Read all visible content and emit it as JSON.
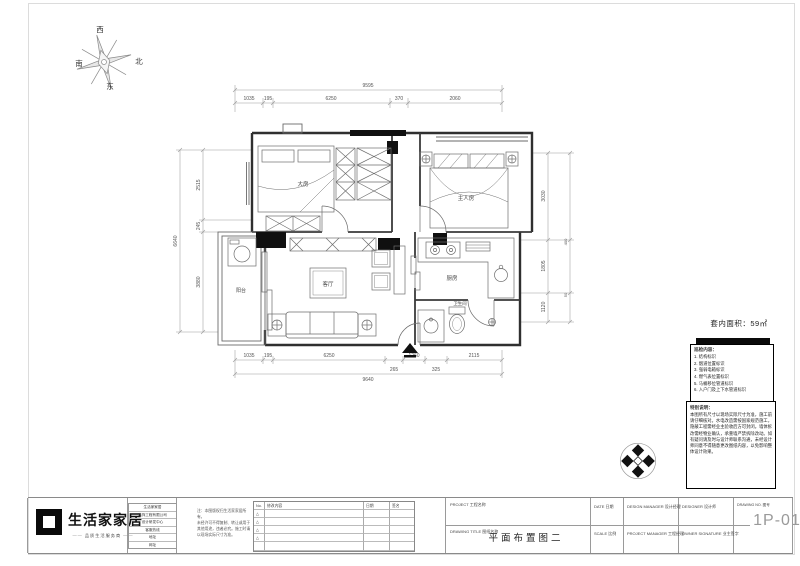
{
  "compass": {
    "west": "西",
    "north": "北",
    "south": "南",
    "east": "东"
  },
  "plan": {
    "rooms": {
      "bedroom": "大房",
      "master": "主人房",
      "kitchen": "厨房",
      "bath": "卫生间",
      "living": "客厅",
      "balcony": "阳台"
    },
    "dims": {
      "top": {
        "total": "9595",
        "segs": [
          "1035",
          "195",
          "6250",
          "370",
          "2060"
        ]
      },
      "bottom": {
        "segs": [
          "1035",
          "195",
          "6250",
          "1260",
          "2115"
        ],
        "sub": [
          "265",
          "325"
        ],
        "total": "9640"
      },
      "left": {
        "total": "6640",
        "segs": [
          "2515",
          "245",
          "3880"
        ]
      },
      "right": {
        "segs": [
          "3030",
          "1805",
          "1120"
        ],
        "sub": [
          "400",
          "50"
        ]
      }
    }
  },
  "info": {
    "area": "套内面积：59㎡",
    "legend_title": "巡检内容：",
    "legend_items": [
      "1. 结构标识",
      "2. 烟道位置标识",
      "3. 强弱电箱标识",
      "4. 燃气表位置标识",
      "5. 马桶移位管道标识",
      "6. 入户门及上下水管道标识"
    ],
    "notes_title": "特别说明：",
    "notes_body": "本图所有尺寸以现场实际尺寸为准，施工前请仔细核对。水电改造需按国家规范施工，隐蔽工程需经业主验收后方可封闭。墙体拆改需经物业确认，承重墙严禁拆除改动。如有疑问请及时与设计师联系沟通，未经设计师同意不得随意更改图纸内容，以免影响整体设计效果。"
  },
  "titlebar": {
    "brand": "生活家家居",
    "slogan": "品质生活服务商",
    "company_rows": [
      "生活家家居",
      "装饰工程有限公司",
      "设计研发中心",
      "客服热线",
      "地址",
      "网址"
    ],
    "note_lines": [
      "注：本图版权归生活家家居所有，",
      "未经许可不得复制、转让或用于",
      "其他用途，违者必究。施工时请",
      "以现场实际尺寸为准。"
    ],
    "rev": {
      "headers": [
        "No.",
        "修改内容",
        "日期",
        "签名"
      ],
      "marks": [
        "△",
        "△",
        "△",
        "△"
      ]
    },
    "project_label": "PROJECT  工程名称",
    "title_label": "DRAWING TITLE  图纸名称",
    "drawing_title": "平面布置图二",
    "date_label": "DATE  日期",
    "scale_label": "SCALE  比例",
    "design_mgr_label": "DESIGN MANAGER  设计经理",
    "project_mgr_label": "PROJECT MANAGER  工程经理",
    "designer_label": "DESIGNER  设计师",
    "owner_label": "OWNER SIGNATURE  业主签字",
    "drawing_no_label": "DRAWING NO.  图号",
    "drawing_no": "1P-01"
  }
}
